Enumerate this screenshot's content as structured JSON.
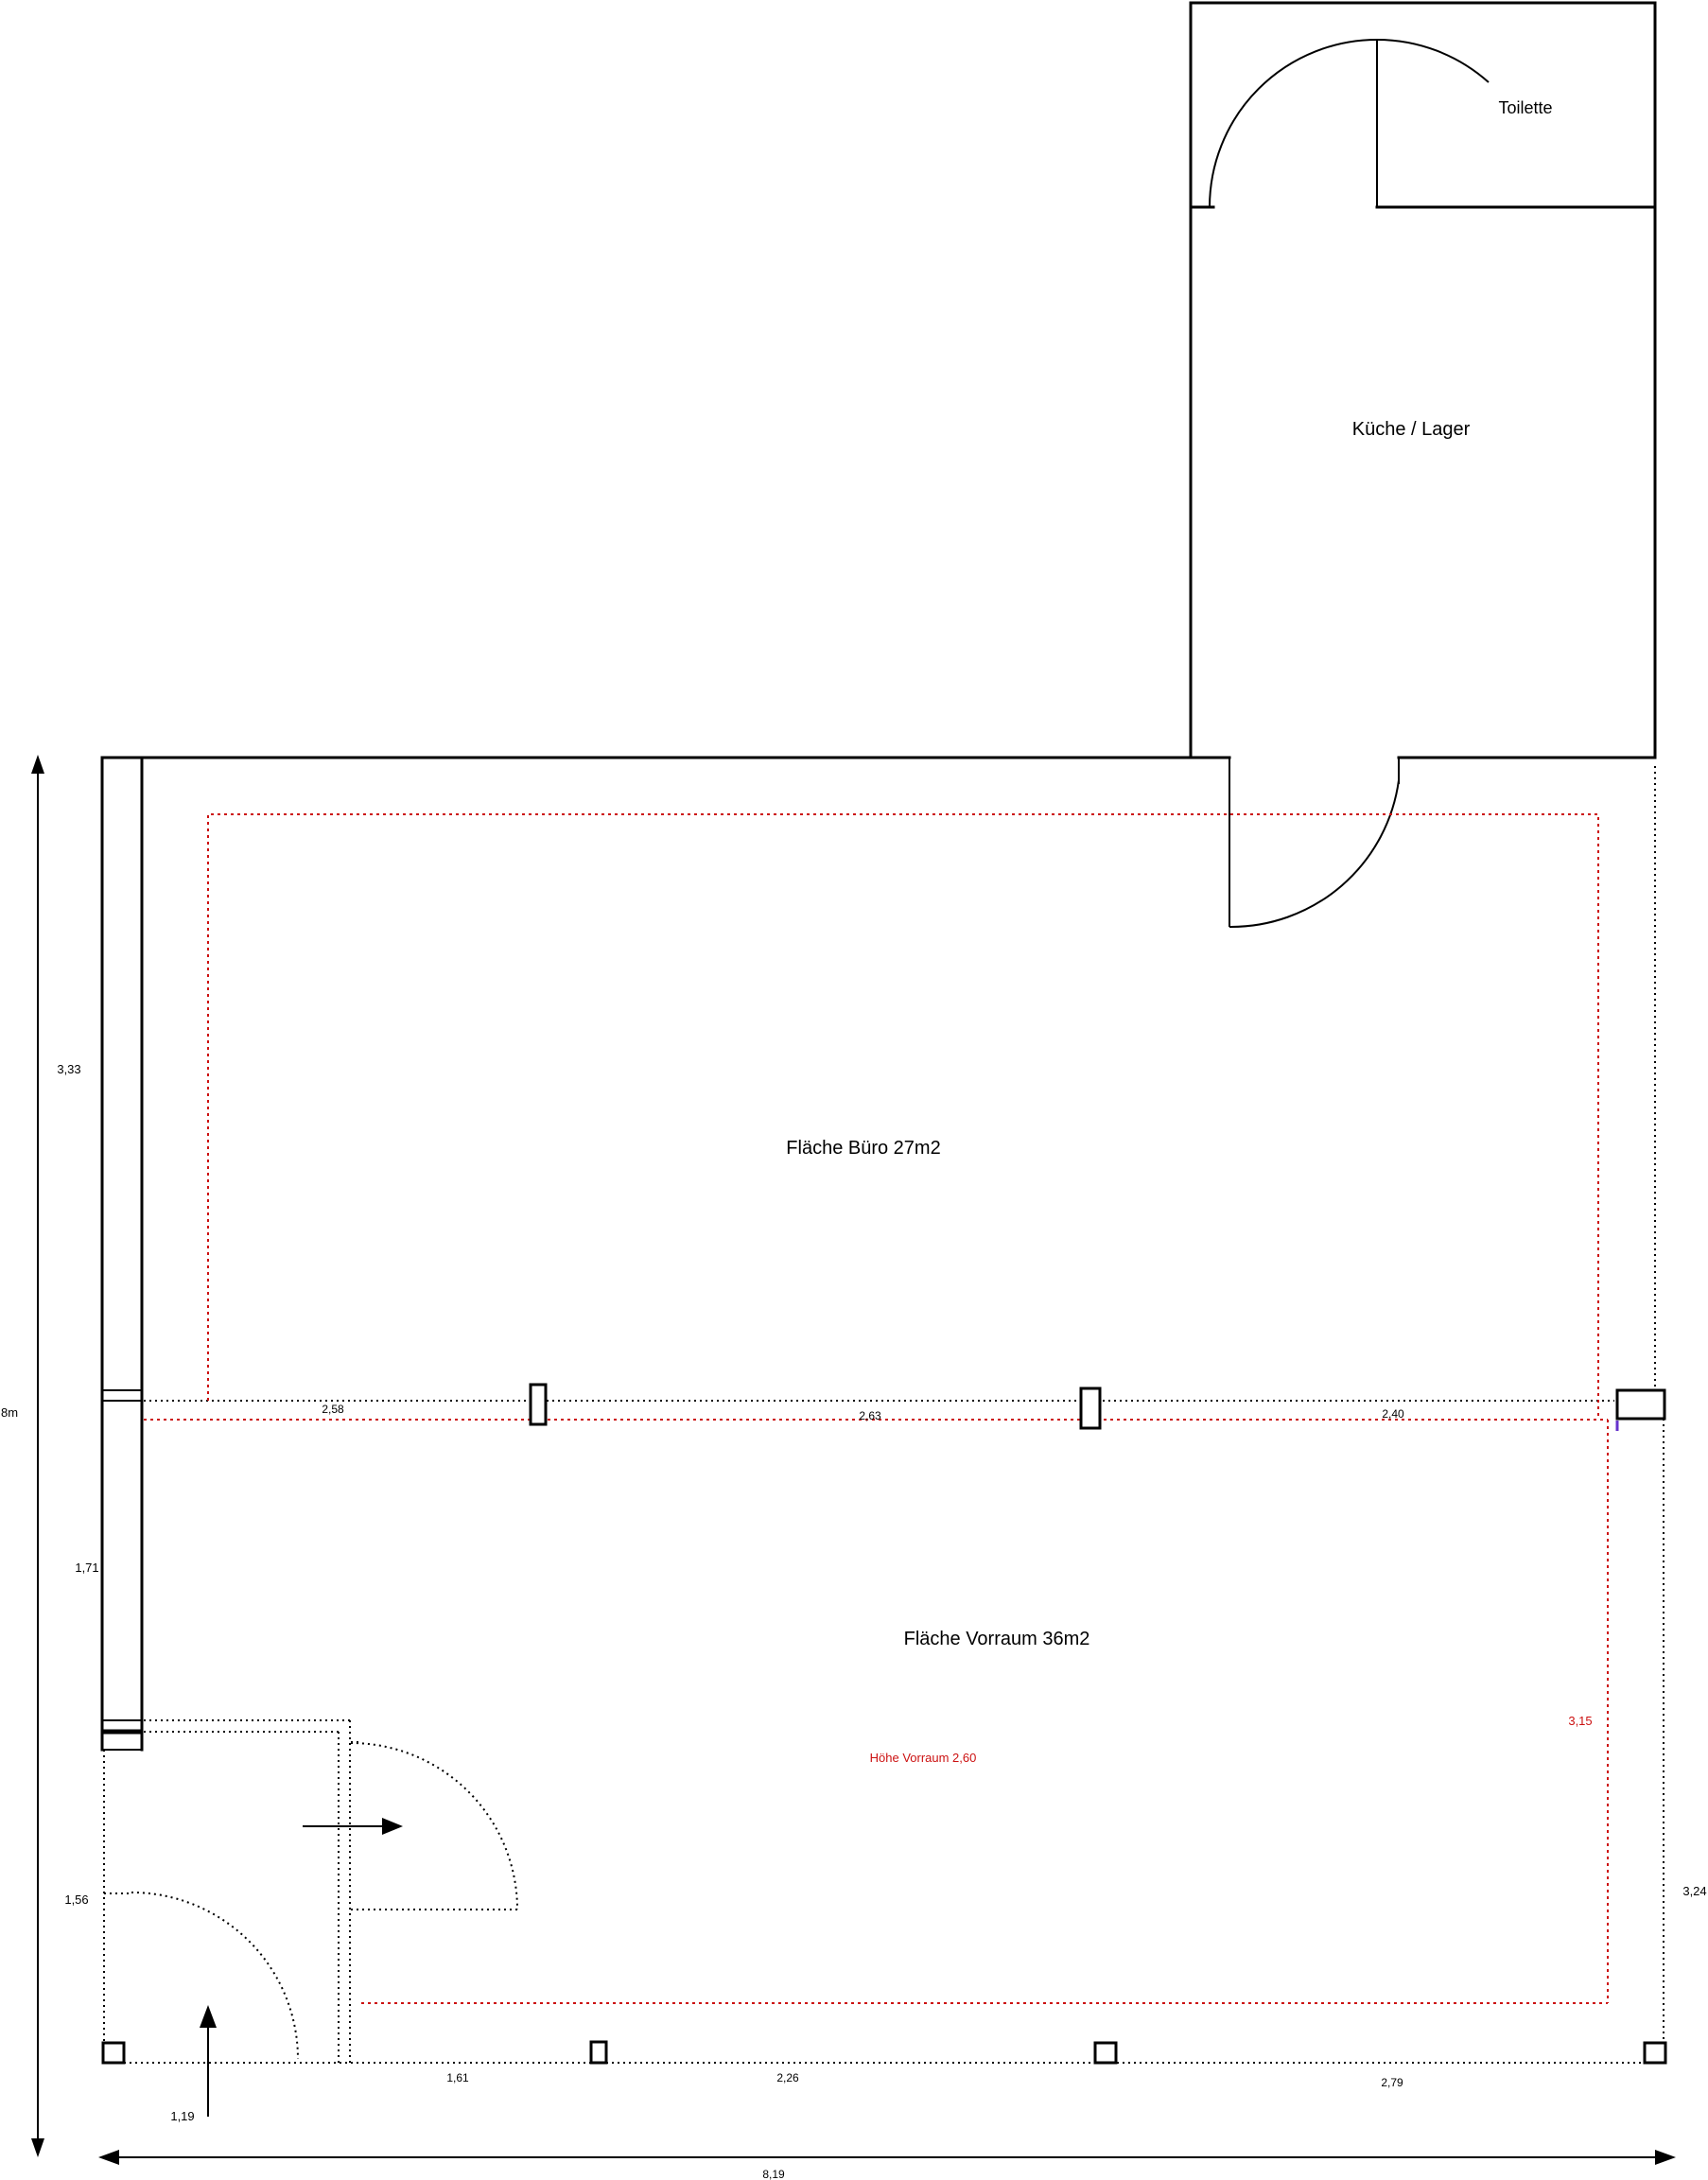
{
  "plan": {
    "rooms": {
      "toilette": "Toilette",
      "kueche_lager": "Küche / Lager",
      "buero": "Fläche Büro 27m2",
      "vorraum": "Fläche Vorraum 36m2"
    },
    "annotations": {
      "hoehe_vorraum": "Höhe Vorraum 2,60"
    },
    "dimensions": {
      "left": {
        "segment_top": "3,33",
        "total_height": "8m",
        "segment_mid": "1,71",
        "segment_low": "1,56",
        "entry_arrow": "1,19"
      },
      "middle_line": {
        "seg1": "2,58",
        "seg2": "2,63",
        "seg3": "2,40"
      },
      "bottom": {
        "seg1": "1,61",
        "seg2": "2,26",
        "seg3": "2,79",
        "total_width": "8,19"
      },
      "right": {
        "vorraum_height_red": "3,15",
        "outer_height": "3,24"
      }
    },
    "colors": {
      "wall": "#000000",
      "red_dim": "#cc1111",
      "blue_mark": "#6633cc"
    }
  }
}
